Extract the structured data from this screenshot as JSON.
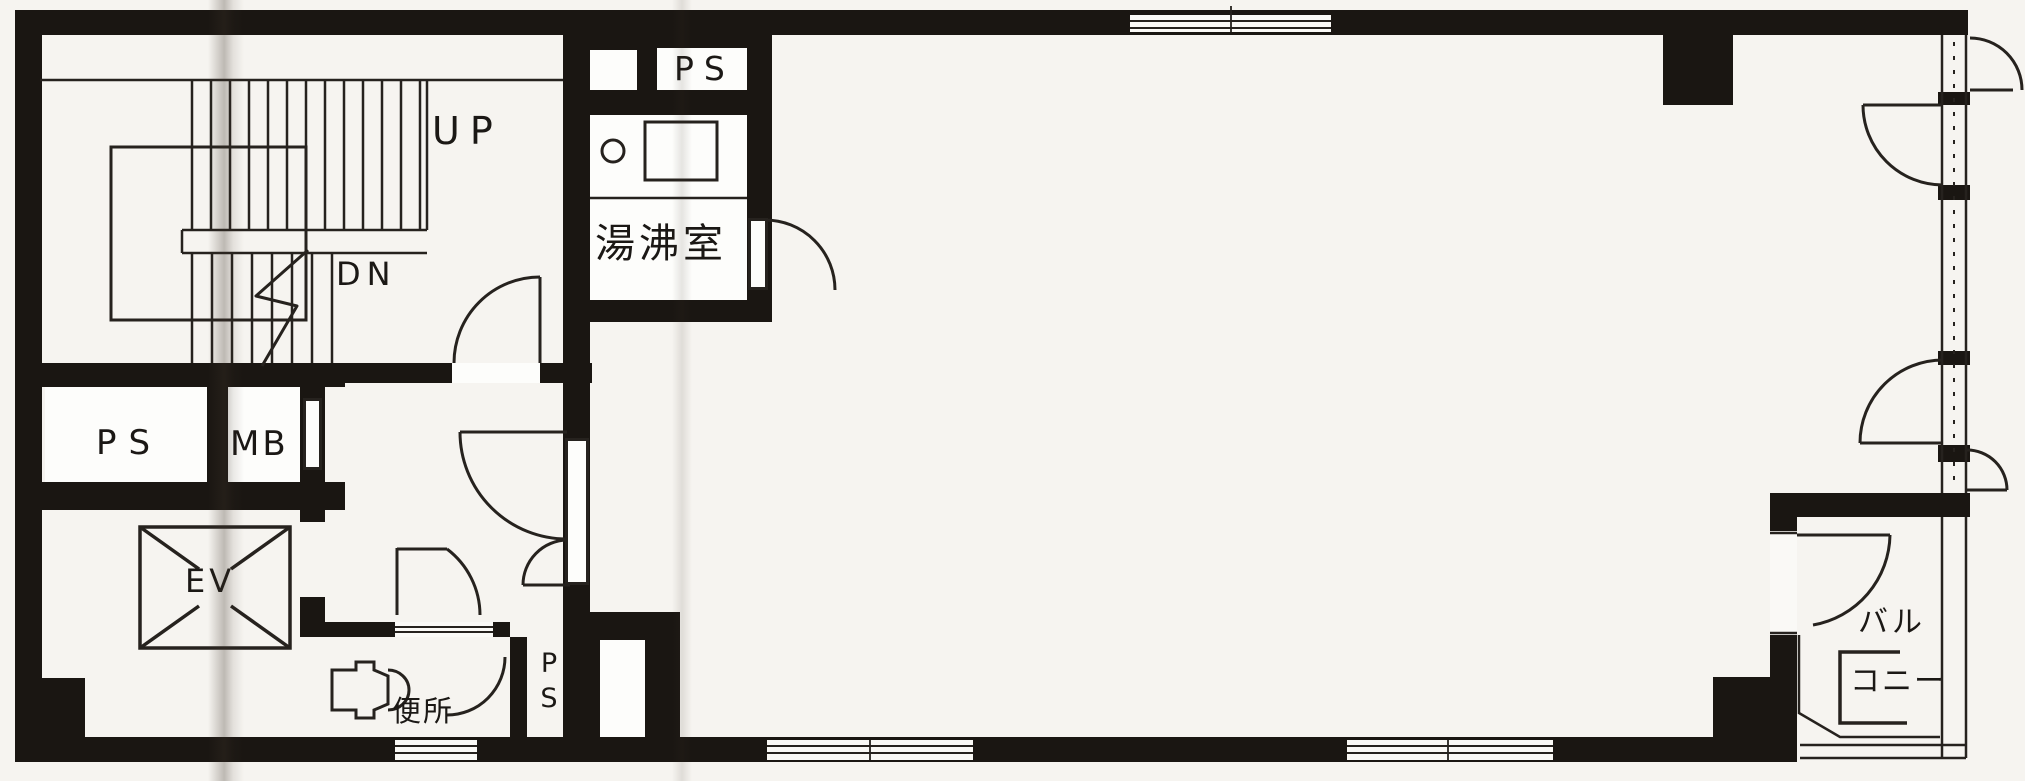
{
  "plan": {
    "stairwell": {
      "up": "UP",
      "dn": "DN"
    },
    "pipe_space_top": "PS",
    "kitchenette": "湯沸室",
    "pipe_space_left": "PS",
    "meter_box": "MB",
    "elevator": "EV",
    "toilet": "便所",
    "pipe_space_bottom": {
      "line1": "P",
      "line2": "S"
    },
    "balcony": {
      "line1": "バル",
      "line2": "コニー"
    },
    "colors": {
      "wall": "#1a1612",
      "paper": "#f6f4f0",
      "room": "#fdfdfb",
      "line": "#26221e"
    }
  }
}
